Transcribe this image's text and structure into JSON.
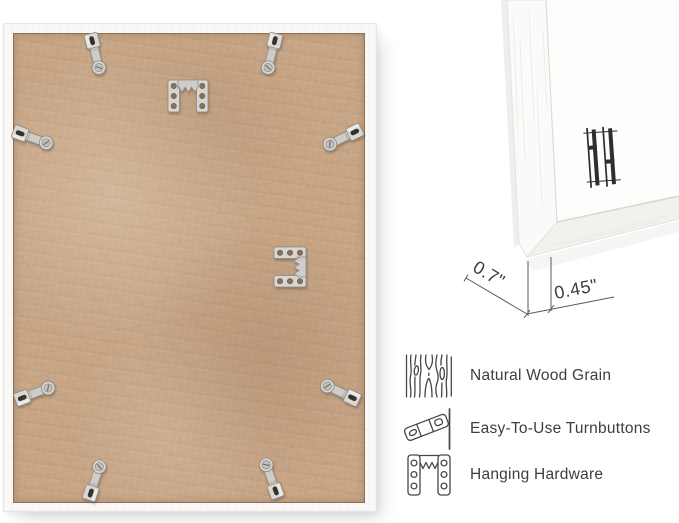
{
  "page": {
    "background": "#ffffff"
  },
  "closeup": {
    "depth_label": "0.7\"",
    "face_width_label": "0.45\"",
    "brand_mark_icon": "hh-brand-logo-icon"
  },
  "frame_back": {
    "hardware": {
      "turnbutton_count": 8,
      "sawtooth_hanger_count": 2
    }
  },
  "features": {
    "items": [
      {
        "icon": "wood-grain-icon",
        "label": "Natural Wood Grain"
      },
      {
        "icon": "turnbutton-icon",
        "label": "Easy-To-Use Turnbuttons"
      },
      {
        "icon": "hanging-hardware-icon",
        "label": "Hanging Hardware"
      }
    ]
  },
  "colors": {
    "board_tan": "#c7a585",
    "frame_white": "#faf9f7",
    "hardware_silver": "#d9d6d2",
    "annotation_ink": "#3d3d3d",
    "label_text": "#3e3e3e",
    "logo_ink": "#2e2e2e"
  }
}
